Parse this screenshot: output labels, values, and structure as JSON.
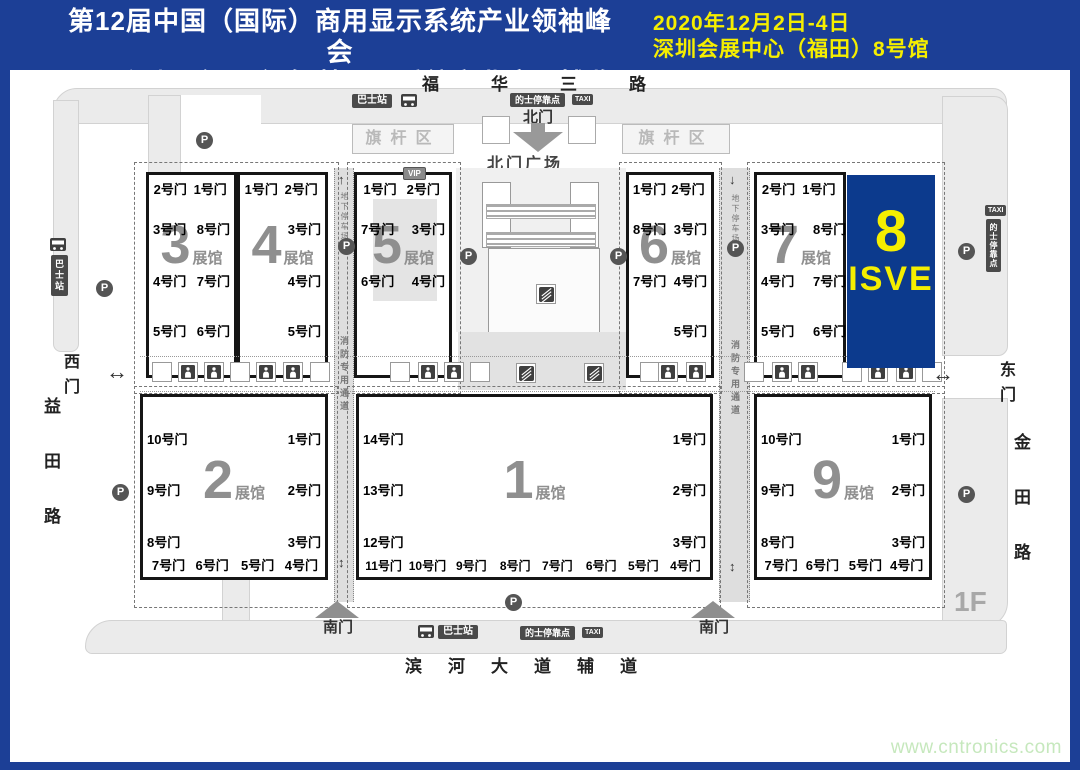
{
  "banner": {
    "title_line1": "第12届中国（国际）商用显示系统产业领袖峰会",
    "title_line2": "2020深圳（国际）智慧显示系统产业应用博览会",
    "date_line1": "2020年12月2日-4日",
    "date_line2": "深圳会展中心（福田）8号馆"
  },
  "map": {
    "road_top": "福华三路",
    "road_bottom": "滨河大道辅道",
    "road_left": "益田路",
    "road_right": "金田路",
    "gate_north": "北门",
    "gate_south": "南门",
    "gate_west": "西门",
    "gate_east": "东门",
    "north_plaza": "北门广场",
    "flag_area": "旗杆区",
    "halls": [
      {
        "number": "3",
        "row": "top",
        "rect": [
          146,
          172,
          91,
          206
        ],
        "gates": {
          "top": [
            "2号门",
            "1号门"
          ],
          "left": [
            "3号门",
            "4号门",
            "5号门"
          ],
          "right": [
            "8号门",
            "7号门",
            "6号门"
          ]
        }
      },
      {
        "number": "4",
        "row": "top",
        "rect": [
          237,
          172,
          91,
          206
        ],
        "gates": {
          "top": [
            "1号门",
            "2号门"
          ],
          "right": [
            "3号门",
            "4号门",
            "5号门"
          ]
        }
      },
      {
        "number": "5",
        "row": "top",
        "rect": [
          354,
          172,
          98,
          206
        ],
        "vip": true,
        "core": true,
        "gates": {
          "top": [
            "1号门",
            "2号门"
          ],
          "left": [
            "7号门",
            "6号门"
          ],
          "right": [
            "3号门",
            "4号门"
          ]
        }
      },
      {
        "number": "6",
        "row": "top",
        "rect": [
          626,
          172,
          88,
          206
        ],
        "gates": {
          "top": [
            "1号门",
            "2号门"
          ],
          "left": [
            "8号门",
            "7号门"
          ],
          "right": [
            "3号门",
            "4号门",
            "5号门"
          ]
        }
      },
      {
        "number": "7",
        "row": "top",
        "rect": [
          754,
          172,
          92,
          206
        ],
        "right_shift": true,
        "gates": {
          "top": [
            "2号门",
            "1号门"
          ],
          "left": [
            "3号门",
            "4号门",
            "5号门"
          ],
          "right": [
            "8号门",
            "7号门",
            "6号门"
          ]
        }
      },
      {
        "number": "2",
        "row": "bottom",
        "rect": [
          140,
          394,
          188,
          186
        ],
        "gates": {
          "left": [
            "10号门",
            "9号门",
            "8号门"
          ],
          "right": [
            "1号门",
            "2号门",
            "3号门"
          ],
          "bottom": [
            "7号门",
            "6号门",
            "5号门",
            "4号门"
          ]
        }
      },
      {
        "number": "1",
        "row": "bottom",
        "rect": [
          356,
          394,
          357,
          186
        ],
        "gates": {
          "left": [
            "14号门",
            "13号门",
            "12号门"
          ],
          "right": [
            "1号门",
            "2号门",
            "3号门"
          ],
          "bottom": [
            "11号门",
            "10号门",
            "9号门",
            "8号门",
            "7号门",
            "6号门",
            "5号门",
            "4号门"
          ]
        }
      },
      {
        "number": "9",
        "row": "bottom",
        "rect": [
          754,
          394,
          178,
          186
        ],
        "gates": {
          "left": [
            "10号门",
            "9号门",
            "8号门"
          ],
          "right": [
            "1号门",
            "2号门",
            "3号门"
          ],
          "bottom": [
            "7号门",
            "6号门",
            "5号门",
            "4号门"
          ]
        }
      }
    ]
  },
  "hall8": {
    "number": "8",
    "brand": "ISVE"
  },
  "labels": {
    "bus_station": "巴士站",
    "taxi_stop": "的士停靠点",
    "taxi": "TAXI",
    "vip": "VIP",
    "parking": "P",
    "underground_parking": "地下停车场",
    "fire_lane": "消防专用通道",
    "hall_suffix": "展馆",
    "floor": "1F"
  },
  "colors": {
    "frame_blue": "#1c3f96",
    "hall8_blue": "#0c3a8d",
    "highlight_yellow": "#f5ee00",
    "watermark_green": "#c6e8bd"
  },
  "watermark": "www.cntronics.com",
  "layout": {
    "blocks": [
      [
        134,
        162,
        203,
        230
      ],
      [
        347,
        162,
        112,
        230
      ],
      [
        619,
        162,
        101,
        230
      ],
      [
        747,
        162,
        196,
        230
      ],
      [
        134,
        386,
        202,
        220
      ],
      [
        347,
        386,
        372,
        220
      ],
      [
        747,
        386,
        196,
        220
      ]
    ],
    "parking_icons": [
      [
        96,
        280
      ],
      [
        112,
        484
      ],
      [
        338,
        238
      ],
      [
        460,
        248
      ],
      [
        610,
        248
      ],
      [
        727,
        240
      ],
      [
        958,
        243
      ],
      [
        958,
        486
      ],
      [
        505,
        594
      ],
      [
        196,
        132
      ]
    ],
    "restrooms": [
      [
        178,
        362
      ],
      [
        204,
        362
      ],
      [
        256,
        362
      ],
      [
        283,
        362
      ],
      [
        418,
        362
      ],
      [
        444,
        362
      ],
      [
        658,
        362
      ],
      [
        686,
        362
      ],
      [
        772,
        362
      ],
      [
        798,
        362
      ],
      [
        868,
        362
      ],
      [
        896,
        362
      ]
    ],
    "escalators": [
      [
        516,
        363
      ],
      [
        584,
        363
      ],
      [
        536,
        284
      ]
    ],
    "plain_boxes": [
      [
        152,
        362
      ],
      [
        230,
        362
      ],
      [
        310,
        362
      ],
      [
        390,
        362
      ],
      [
        470,
        362
      ],
      [
        640,
        362
      ],
      [
        744,
        362
      ],
      [
        842,
        362
      ],
      [
        922,
        362
      ]
    ]
  }
}
